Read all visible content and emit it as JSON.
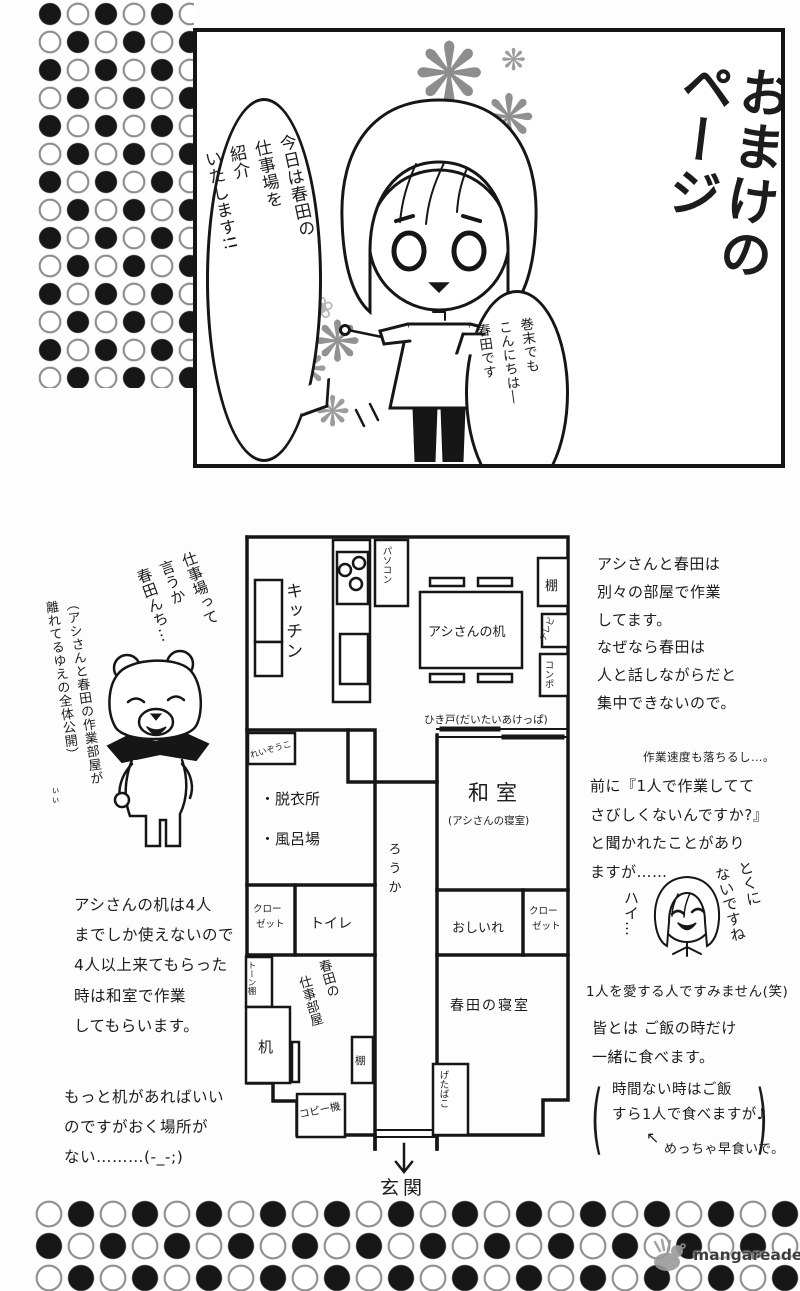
{
  "top_panel": {
    "title": "おまけの\nページ",
    "bubble_intro": "今日は春田の\n仕事場を\n紹介\nいたします!!",
    "bubble_greeting": "巻末でも\nこんにちは―\n春田です"
  },
  "icons": {
    "flower_filled": "❋",
    "flower_outline": "❀",
    "arrow_upleft": "↖",
    "paren_open": "(",
    "paren_close": ")"
  },
  "left_column": {
    "bear_caption": "仕事場って\n言うか\n春田んち…",
    "bear_note": "（アシさんと春田の作業部屋が\n離れてるゆえの全体公開）",
    "bear_note_small": "ぃぃ",
    "note1": "アシさんの机は4人\nまでしか使えないので\n4人以上来てもらった\n時は和室で作業\nしてもらいます。",
    "note2": "もっと机があればいい\nのですがおく場所が\nない………(-_-;)"
  },
  "right_column": {
    "para1": "アシさんと春田は\n別々の部屋で作業\nしてます。\nなぜなら春田は\n人と話しながらだと\n集中できないので。",
    "para1_note": "作業速度も落ちるし…。",
    "para2": "前に『1人で作業してて\nさびしくないんですか?』\nと聞かれたことがあり\nますが……",
    "reply_left": "ハイ…",
    "reply_right": "とくに\nないですね",
    "reply_caption": "1人を愛する人ですみません(笑)",
    "para3": "皆とは ご飯の時だけ\n一緒に食べます。",
    "para3_paren": "時間ない時はご飯\nすら1人で食べますが♪",
    "para3_note": "めっちゃ早食いで。"
  },
  "floor_plan": {
    "labels": {
      "kitchen": "キッチン",
      "pc": "パソコン",
      "fridge": "れいぞうこ",
      "assistant_desk": "アシさんの机",
      "shelf_top": "棚",
      "tv": "テレビ",
      "compo": "コンポ",
      "sliding_door": "ひき戸(だいたいあけっぱ)",
      "washroom_l1": "・脱衣所",
      "washroom_l2": "・風呂場",
      "hallway": "ろうか",
      "washitsu": "和室",
      "washitsu_sub": "(アシさんの寝室)",
      "closet_l1": "クロー",
      "closet_l2": "ゼット",
      "toilet": "トイレ",
      "oshiire": "おしいれ",
      "tone_shelf": "トーン棚",
      "desk": "机",
      "haruta_room_l1": "春田の",
      "haruta_room_l2": "仕事部屋",
      "shelf_small": "棚",
      "copier": "コピー機",
      "haruta_bedroom": "春田の寝室",
      "getabako": "げたばこ",
      "entrance": "玄関"
    }
  },
  "footer": {
    "watermark": "mangareader.net"
  }
}
